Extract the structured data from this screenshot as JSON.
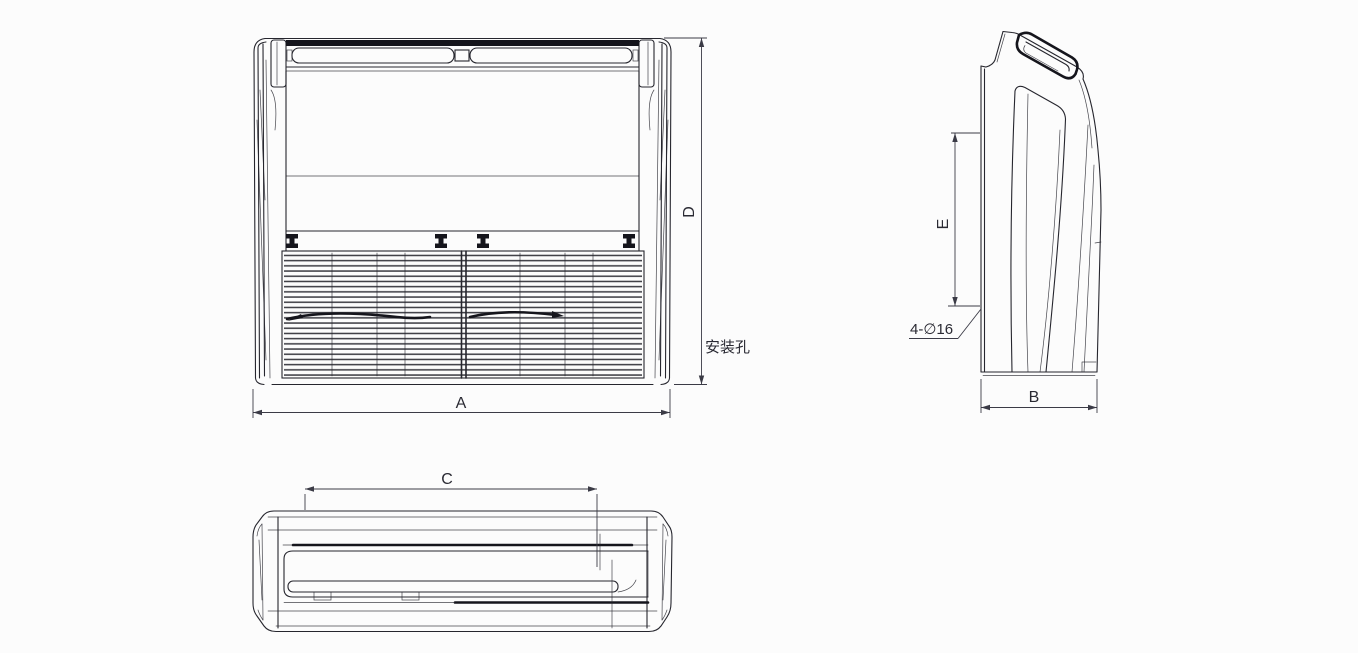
{
  "colors": {
    "background": "#fcfcfc",
    "line": "#26262e",
    "dimension_line": "#3b3b46",
    "dark_fill": "#15151c",
    "text": "#2a2a33"
  },
  "annotations": {
    "dim_width_front": "A",
    "dim_depth_side": "B",
    "dim_hanger_spacing": "C",
    "dim_height_front": "D",
    "dim_hole_offset_side": "E",
    "hole_spec": "4-∅16",
    "mounting_hole": "安装孔"
  }
}
